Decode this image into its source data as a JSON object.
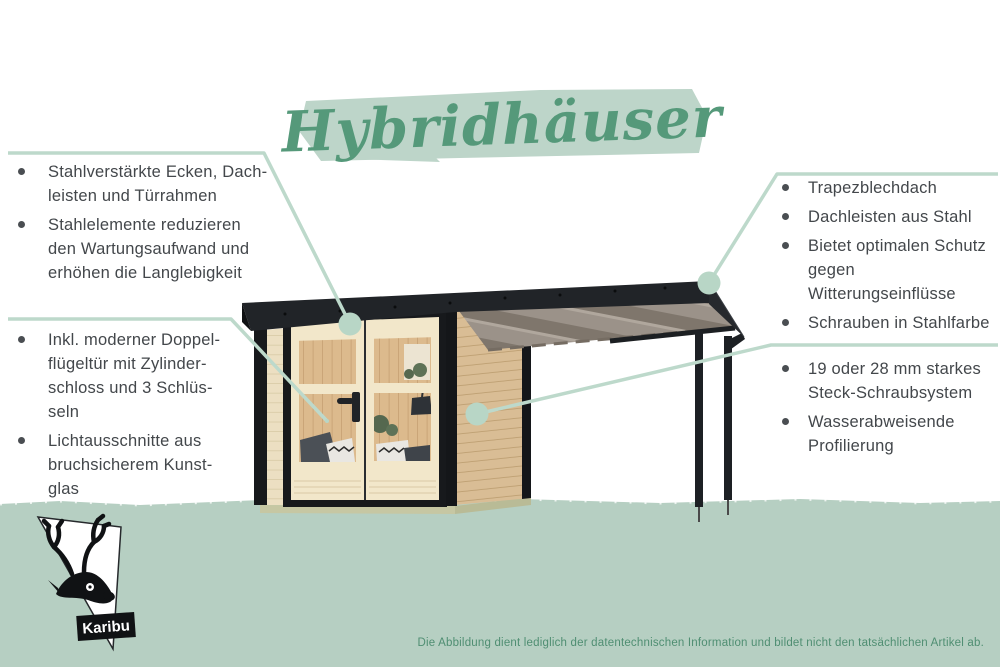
{
  "title": "Hybridhäuser",
  "annotations": {
    "top_left": {
      "items": [
        "Stahlverstärkte Ecken, Dach-\nleisten und Türrahmen",
        "Stahlelemente reduzieren\nden Wartungsaufwand und\nerhöhen die Langlebigkeit"
      ]
    },
    "bottom_left": {
      "items": [
        "Inkl. moderner Doppel-\nflügeltür mit Zylinder-\nschloss und 3 Schlüs-\nseln",
        "Lichtausschnitte aus\nbruchsicherem Kunst-\nglas"
      ]
    },
    "top_right": {
      "items": [
        "Trapezblechdach",
        "Dachleisten aus Stahl",
        "Bietet optimalen Schutz\ngegen Witterungseinflüsse",
        "Schrauben in Stahlfarbe"
      ]
    },
    "bottom_right": {
      "items": [
        "19 oder 28 mm starkes\nSteck-Schraubsystem",
        "Wasserabweisende\nProfilierung"
      ]
    }
  },
  "footer": {
    "disclaimer": "Die Abbildung dient lediglich der datentechnischen Information und bildet nicht den tatsächlichen Artikel ab."
  },
  "logo": {
    "brand": "Karibu"
  },
  "colors": {
    "title_green": "#55997a",
    "brush_green": "#bdd5c9",
    "band_green": "#b6cfc2",
    "line_green": "#bdd9cb",
    "text_dark": "#43474b",
    "footer_green": "#4f8e72"
  }
}
